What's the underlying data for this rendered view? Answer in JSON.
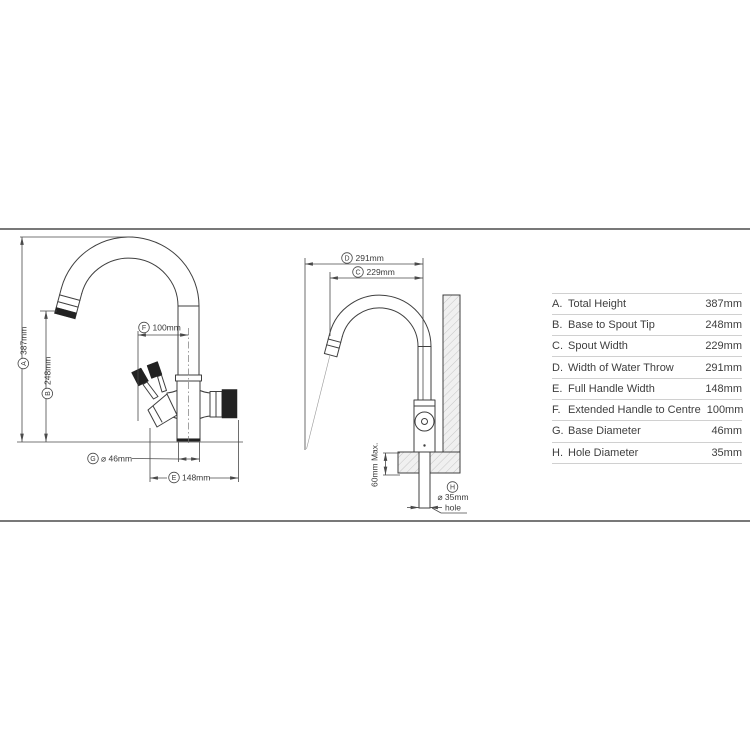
{
  "front_view": {
    "title": "faucet-front-view",
    "dims": {
      "a": {
        "letter": "A",
        "text": "387mm"
      },
      "b": {
        "letter": "B",
        "text": "248mm"
      },
      "f": {
        "letter": "F",
        "text": "100mm"
      },
      "g": {
        "letter": "G",
        "text": "⌀ 46mm"
      },
      "e": {
        "letter": "E",
        "text": "148mm"
      }
    }
  },
  "side_view": {
    "title": "faucet-side-view",
    "dims": {
      "d": {
        "letter": "D",
        "text": "291mm"
      },
      "c": {
        "letter": "C",
        "text": "229mm"
      },
      "depth_max": "60mm Max.",
      "h": {
        "letter": "H",
        "text": "⌀ 35mm",
        "text2": "hole"
      }
    }
  },
  "spec_table": {
    "rows": [
      {
        "key": "A.",
        "label": "Total Height",
        "value": "387mm"
      },
      {
        "key": "B.",
        "label": "Base to Spout Tip",
        "value": "248mm"
      },
      {
        "key": "C.",
        "label": "Spout Width",
        "value": "229mm"
      },
      {
        "key": "D.",
        "label": "Width of Water Throw",
        "value": "291mm"
      },
      {
        "key": "E.",
        "label": "Full Handle Width",
        "value": "148mm"
      },
      {
        "key": "F.",
        "label": "Extended Handle to Centre",
        "value": "100mm"
      },
      {
        "key": "G.",
        "label": "Base Diameter",
        "value": "46mm"
      },
      {
        "key": "H.",
        "label": "Hole Diameter",
        "value": "35mm"
      }
    ]
  },
  "colors": {
    "line": "#3f3f3f",
    "dimension_line": "#4a4a4a",
    "table_text": "#3e3e3e",
    "table_separator": "#d0d0d0",
    "hatch_fill": "#f0f0f0",
    "hatch_line": "#c6c6c6",
    "handle_grip": "#222222"
  }
}
